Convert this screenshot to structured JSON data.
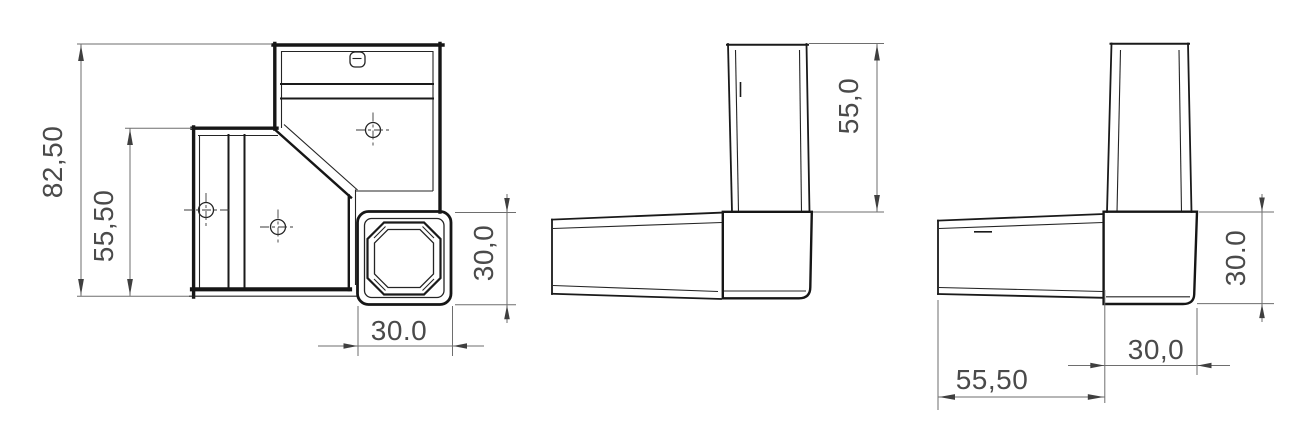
{
  "drawing": {
    "type": "technical-drawing",
    "subject": "square-tube-corner-connector",
    "background_color": "#ffffff",
    "line_color": "#161616",
    "dimension_line_color": "#6e6e6e",
    "dimension_text_color": "#4a4a4a",
    "views": {
      "front": {
        "label": "front-view",
        "dims": {
          "overall_height": "82,50",
          "arm_height": "55,50",
          "socket_width": "30.0",
          "socket_height": "30,0"
        }
      },
      "side": {
        "label": "side-view",
        "dims": {
          "tube_length": "55,0"
        }
      },
      "back": {
        "label": "back-view",
        "dims": {
          "block_height": "30.0",
          "tube_length": "55,50",
          "block_width": "30,0"
        }
      }
    }
  }
}
